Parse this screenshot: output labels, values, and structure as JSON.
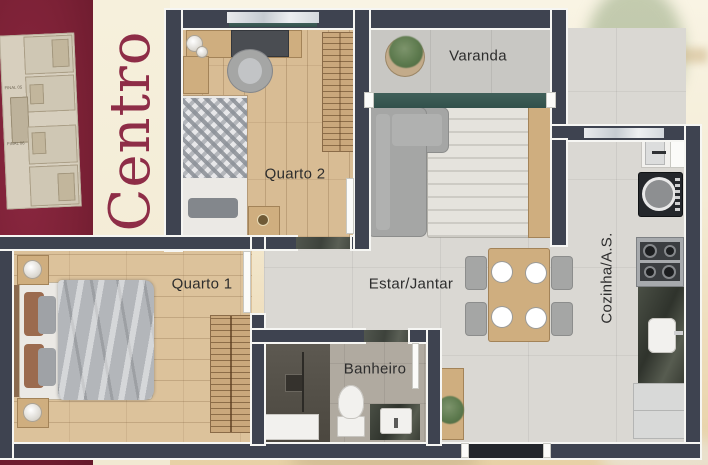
{
  "artwork": {
    "type": "apartment-floor-plan",
    "plan_title": "Centro"
  },
  "key_plan": {
    "unit_labels": [
      "FINAL 05",
      "FINAL 06"
    ]
  },
  "floor_plan": {
    "rooms": [
      {
        "id": "varanda",
        "label": "Varanda"
      },
      {
        "id": "quarto-2",
        "label": "Quarto 2"
      },
      {
        "id": "quarto-1",
        "label": "Quarto 1"
      },
      {
        "id": "estar-jantar",
        "label": "Estar/Jantar"
      },
      {
        "id": "banheiro",
        "label": "Banheiro"
      },
      {
        "id": "cozinha-as",
        "label": "Cozinha/A.S."
      }
    ]
  },
  "colors": {
    "maroon_panel": "#7c2136",
    "title_text": "#8e2d47",
    "cream_band": "#f3ecd7",
    "wall": "#3e4350",
    "wall_trim": "#f6f6f3",
    "wood_floor": "#d8bc94",
    "tile_floor": "#dad8d3",
    "balcony_door_teal": "#3a5551",
    "granite_threshold": "#474c45",
    "room_label_text": "#2d2d2d"
  }
}
